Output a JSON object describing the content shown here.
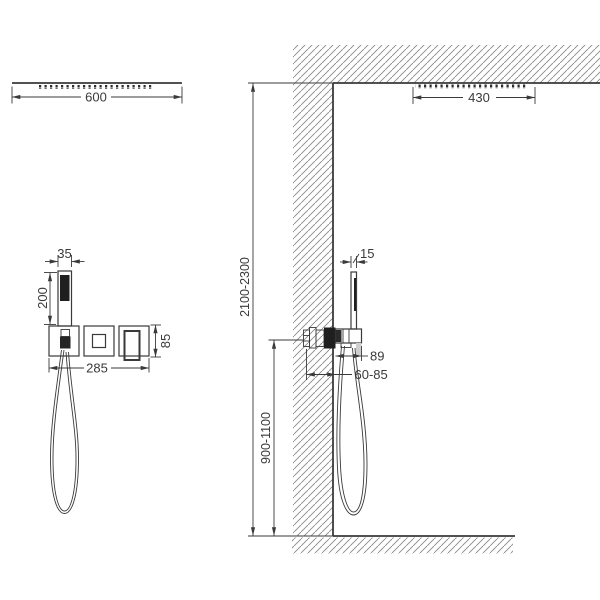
{
  "diagram": {
    "front_view": {
      "overhead_shower_width": "600",
      "hand_shower_width": "35",
      "hand_shower_length": "200",
      "trim_overall_width": "285",
      "trim_plate_size": "85"
    },
    "side_view": {
      "overhead_shower_depth": "430",
      "hand_shower_depth": "15",
      "holder_offset": "89",
      "installation_depth": "60-85",
      "ceiling_height_range": "2100-2300",
      "mixer_height_range": "900-1100"
    },
    "colors": {
      "line": "#3a3a3a",
      "hatch": "#8a8a8a",
      "dark_fill": "#1f1f1f",
      "background": "#ffffff"
    }
  }
}
